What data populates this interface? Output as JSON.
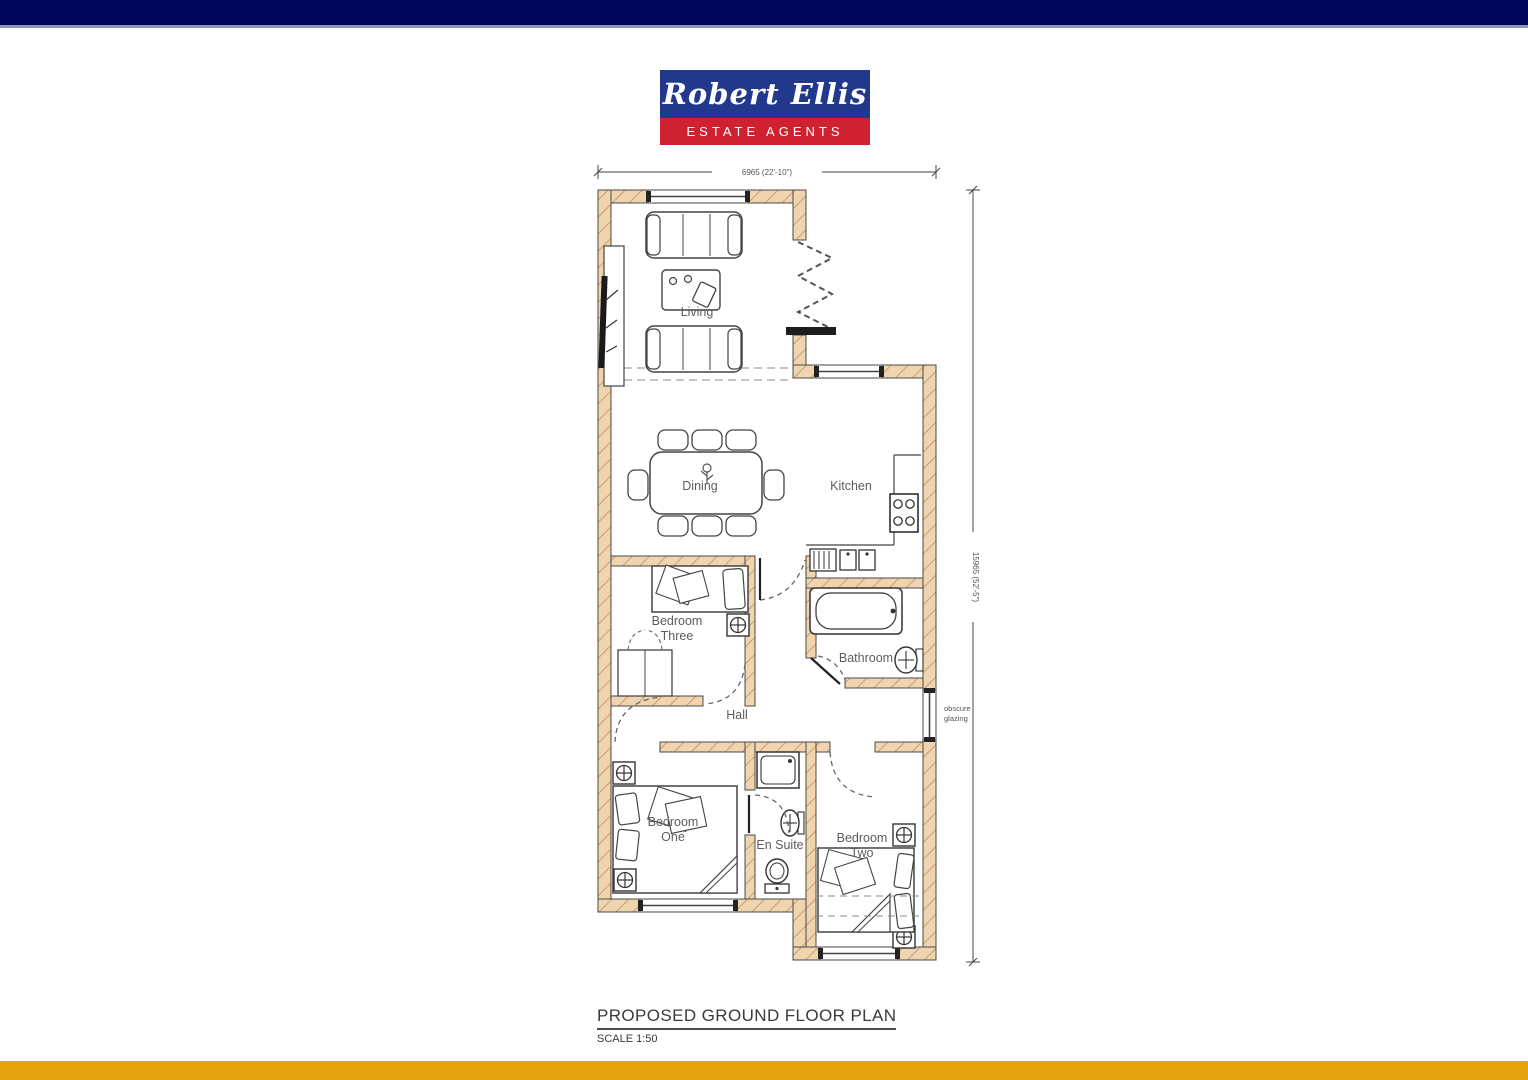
{
  "header_bar": {
    "color": "#01065a",
    "accent_line": "#8e94ba"
  },
  "footer_bar": {
    "color": "#e5a40f"
  },
  "logo": {
    "name": "Robert Ellis",
    "tagline": "ESTATE AGENTS",
    "blue": "#21388c",
    "red": "#ce2131"
  },
  "plan": {
    "title": "PROPOSED GROUND FLOOR PLAN",
    "scale": "SCALE 1:50",
    "dim_width": "6965 (22'-10\")",
    "dim_height": "15965 (52'-5\")",
    "glazing_note_1": "obscure",
    "glazing_note_2": "glazing",
    "labels": {
      "living": "Living",
      "dining": "Dining",
      "kitchen": "Kitchen",
      "bedroom_three_1": "Bedroom",
      "bedroom_three_2": "Three",
      "bathroom": "Bathroom",
      "hall": "Hall",
      "bedroom_one_1": "Bedroom",
      "bedroom_one_2": "One",
      "en_suite": "En Suite",
      "bedroom_two_1": "Bedroom",
      "bedroom_two_2": "Two"
    },
    "colors": {
      "wall_fill": "#efd4af",
      "wall_hatch": "#bb9163",
      "line": "#4a4a4a",
      "label": "#5c5c5c"
    }
  }
}
